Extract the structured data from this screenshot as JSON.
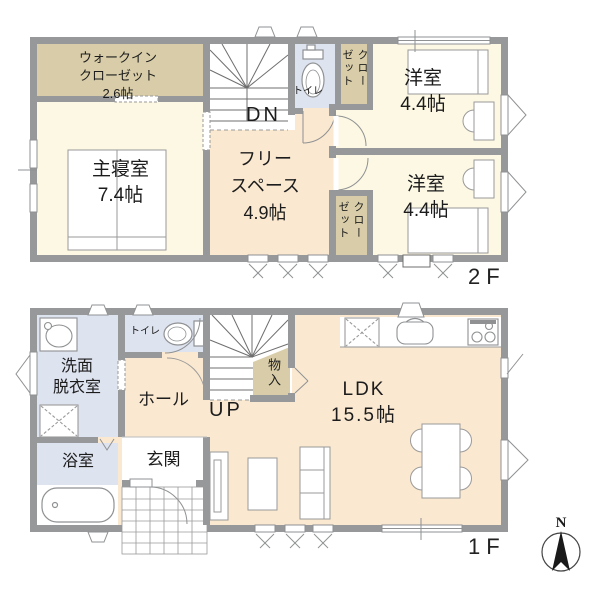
{
  "title": "2階建て住宅 間取り図",
  "floor2": {
    "label": "2F",
    "stairs_label": "DN",
    "rooms": {
      "wic": {
        "line1": "ウォークイン",
        "line2": "クローゼット",
        "size": "2.6帖"
      },
      "master_bedroom": {
        "name": "主寝室",
        "size": "7.4帖"
      },
      "free_space": {
        "line1": "フリー",
        "line2": "スペース",
        "size": "4.9帖"
      },
      "toilet": {
        "name": "トイレ"
      },
      "closet_north": {
        "name": "クローゼット"
      },
      "closet_south": {
        "name": "クローゼット"
      },
      "western_room_north": {
        "name": "洋室",
        "size": "4.4帖"
      },
      "western_room_south": {
        "name": "洋室",
        "size": "4.4帖"
      }
    }
  },
  "floor1": {
    "label": "1F",
    "stairs_label": "UP",
    "rooms": {
      "washroom": {
        "line1": "洗面",
        "line2": "脱衣室"
      },
      "toilet": {
        "name": "トイレ"
      },
      "hall": {
        "name": "ホール"
      },
      "entrance": {
        "name": "玄関"
      },
      "bathroom": {
        "name": "浴室"
      },
      "storage": {
        "name": "物入"
      },
      "ldk": {
        "name": "LDK",
        "size": "15.5帖"
      }
    }
  },
  "compass": {
    "label": "N"
  },
  "colors": {
    "wall": "#97989a",
    "room_cream": "#fcf8e4",
    "room_peach": "#fae8d0",
    "closet_tan": "#d8cda8",
    "wet_area_blue": "#dee3f0",
    "background": "#ffffff"
  }
}
